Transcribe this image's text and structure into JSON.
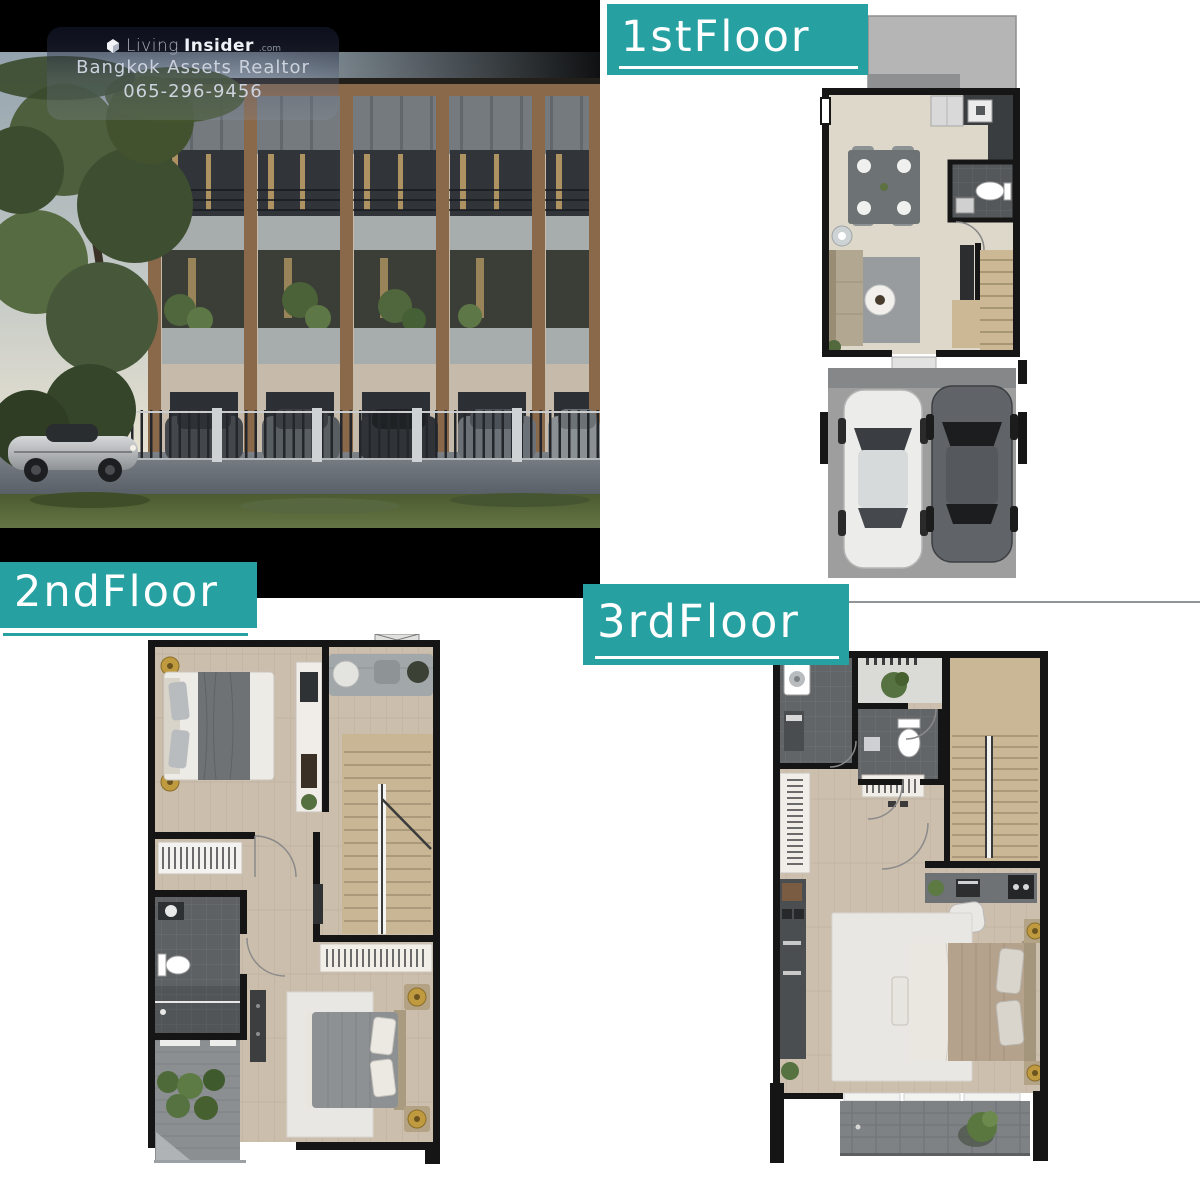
{
  "colors": {
    "accent_teal": "#27a0a1",
    "photo_background": "#000000",
    "divider_gray": "#8f9598"
  },
  "watermark": {
    "logo_icon": "living-insider-cube-icon",
    "brand_regular": "Living",
    "brand_bold": "Insider",
    "brand_suffix": ".com",
    "agency": "Bangkok Assets Realtor",
    "phone": "065-296-9456"
  },
  "floor_plans": {
    "first": {
      "label": "1stFloor"
    },
    "second": {
      "label": "2ndFloor"
    },
    "third": {
      "label": "3rdFloor"
    }
  }
}
